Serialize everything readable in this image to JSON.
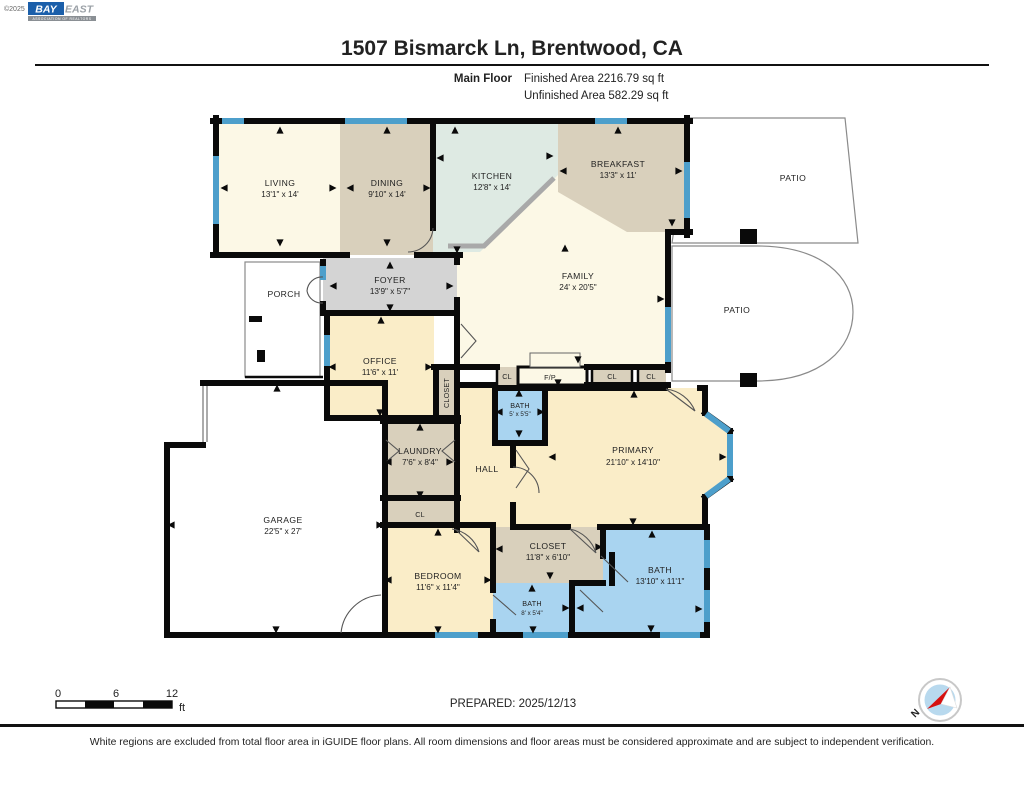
{
  "header": {
    "copyright": "©2025",
    "logo_bay": "BAY",
    "logo_east": "EAST",
    "logo_tagline": "ASSOCIATION OF REALTORS",
    "title": "1507 Bismarck Ln, Brentwood, CA",
    "floor_label": "Main Floor",
    "finished": "Finished Area 2216.79 sq ft",
    "unfinished": "Unfinished Area 582.29 sq ft"
  },
  "rooms": {
    "living": {
      "name": "LIVING",
      "dims": "13'1\" x 14'"
    },
    "dining": {
      "name": "DINING",
      "dims": "9'10\" x 14'"
    },
    "kitchen": {
      "name": "KITCHEN",
      "dims": "12'8\" x 14'"
    },
    "breakfast": {
      "name": "BREAKFAST",
      "dims": "13'3\" x 11'"
    },
    "family": {
      "name": "FAMILY",
      "dims": "24' x 20'5\""
    },
    "patio_top": {
      "name": "PATIO"
    },
    "patio_right": {
      "name": "PATIO"
    },
    "porch": {
      "name": "PORCH"
    },
    "foyer": {
      "name": "FOYER",
      "dims": "13'9\" x 5'7\""
    },
    "office": {
      "name": "OFFICE",
      "dims": "11'6\" x 11'"
    },
    "closet_office": {
      "name": "CLOSET"
    },
    "cl1": {
      "name": "CL"
    },
    "fp": {
      "name": "F/P"
    },
    "cl2": {
      "name": "CL"
    },
    "cl3": {
      "name": "CL"
    },
    "bath_small": {
      "name": "BATH",
      "dims": "5' x 5'5\""
    },
    "primary": {
      "name": "PRIMARY",
      "dims": "21'10\" x 14'10\""
    },
    "hall": {
      "name": "HALL"
    },
    "laundry": {
      "name": "LAUNDRY",
      "dims": "7'6\" x 8'4\""
    },
    "cl_laundry": {
      "name": "CL"
    },
    "garage": {
      "name": "GARAGE",
      "dims": "22'5\" x 27'"
    },
    "bedroom": {
      "name": "BEDROOM",
      "dims": "11'6\" x 11'4\""
    },
    "closet_primary": {
      "name": "CLOSET",
      "dims": "11'8\" x 6'10\""
    },
    "bath_hall": {
      "name": "BATH",
      "dims": "8' x 5'4\""
    },
    "bath_primary": {
      "name": "BATH",
      "dims": "13'10\" x 11'1\""
    }
  },
  "footer": {
    "prepared": "PREPARED: 2025/12/13",
    "compass": "N",
    "scale": {
      "t0": "0",
      "t6": "6",
      "t12": "12",
      "unit": "ft"
    },
    "disclaimer": "White regions are excluded from total floor area in iGUIDE floor plans. All room dimensions and floor areas must be considered approximate and are subject to independent verification."
  },
  "colors": {
    "cream": "#FCF8E6",
    "warm": "#FAEDC8",
    "tan": "#D9D0BC",
    "mint": "#DEEAE3",
    "foyer_gray": "#D4D4D4",
    "bath_blue": "#A9D4F0",
    "window_blue": "#4D9FCB",
    "wall": "#0A0A0A"
  }
}
